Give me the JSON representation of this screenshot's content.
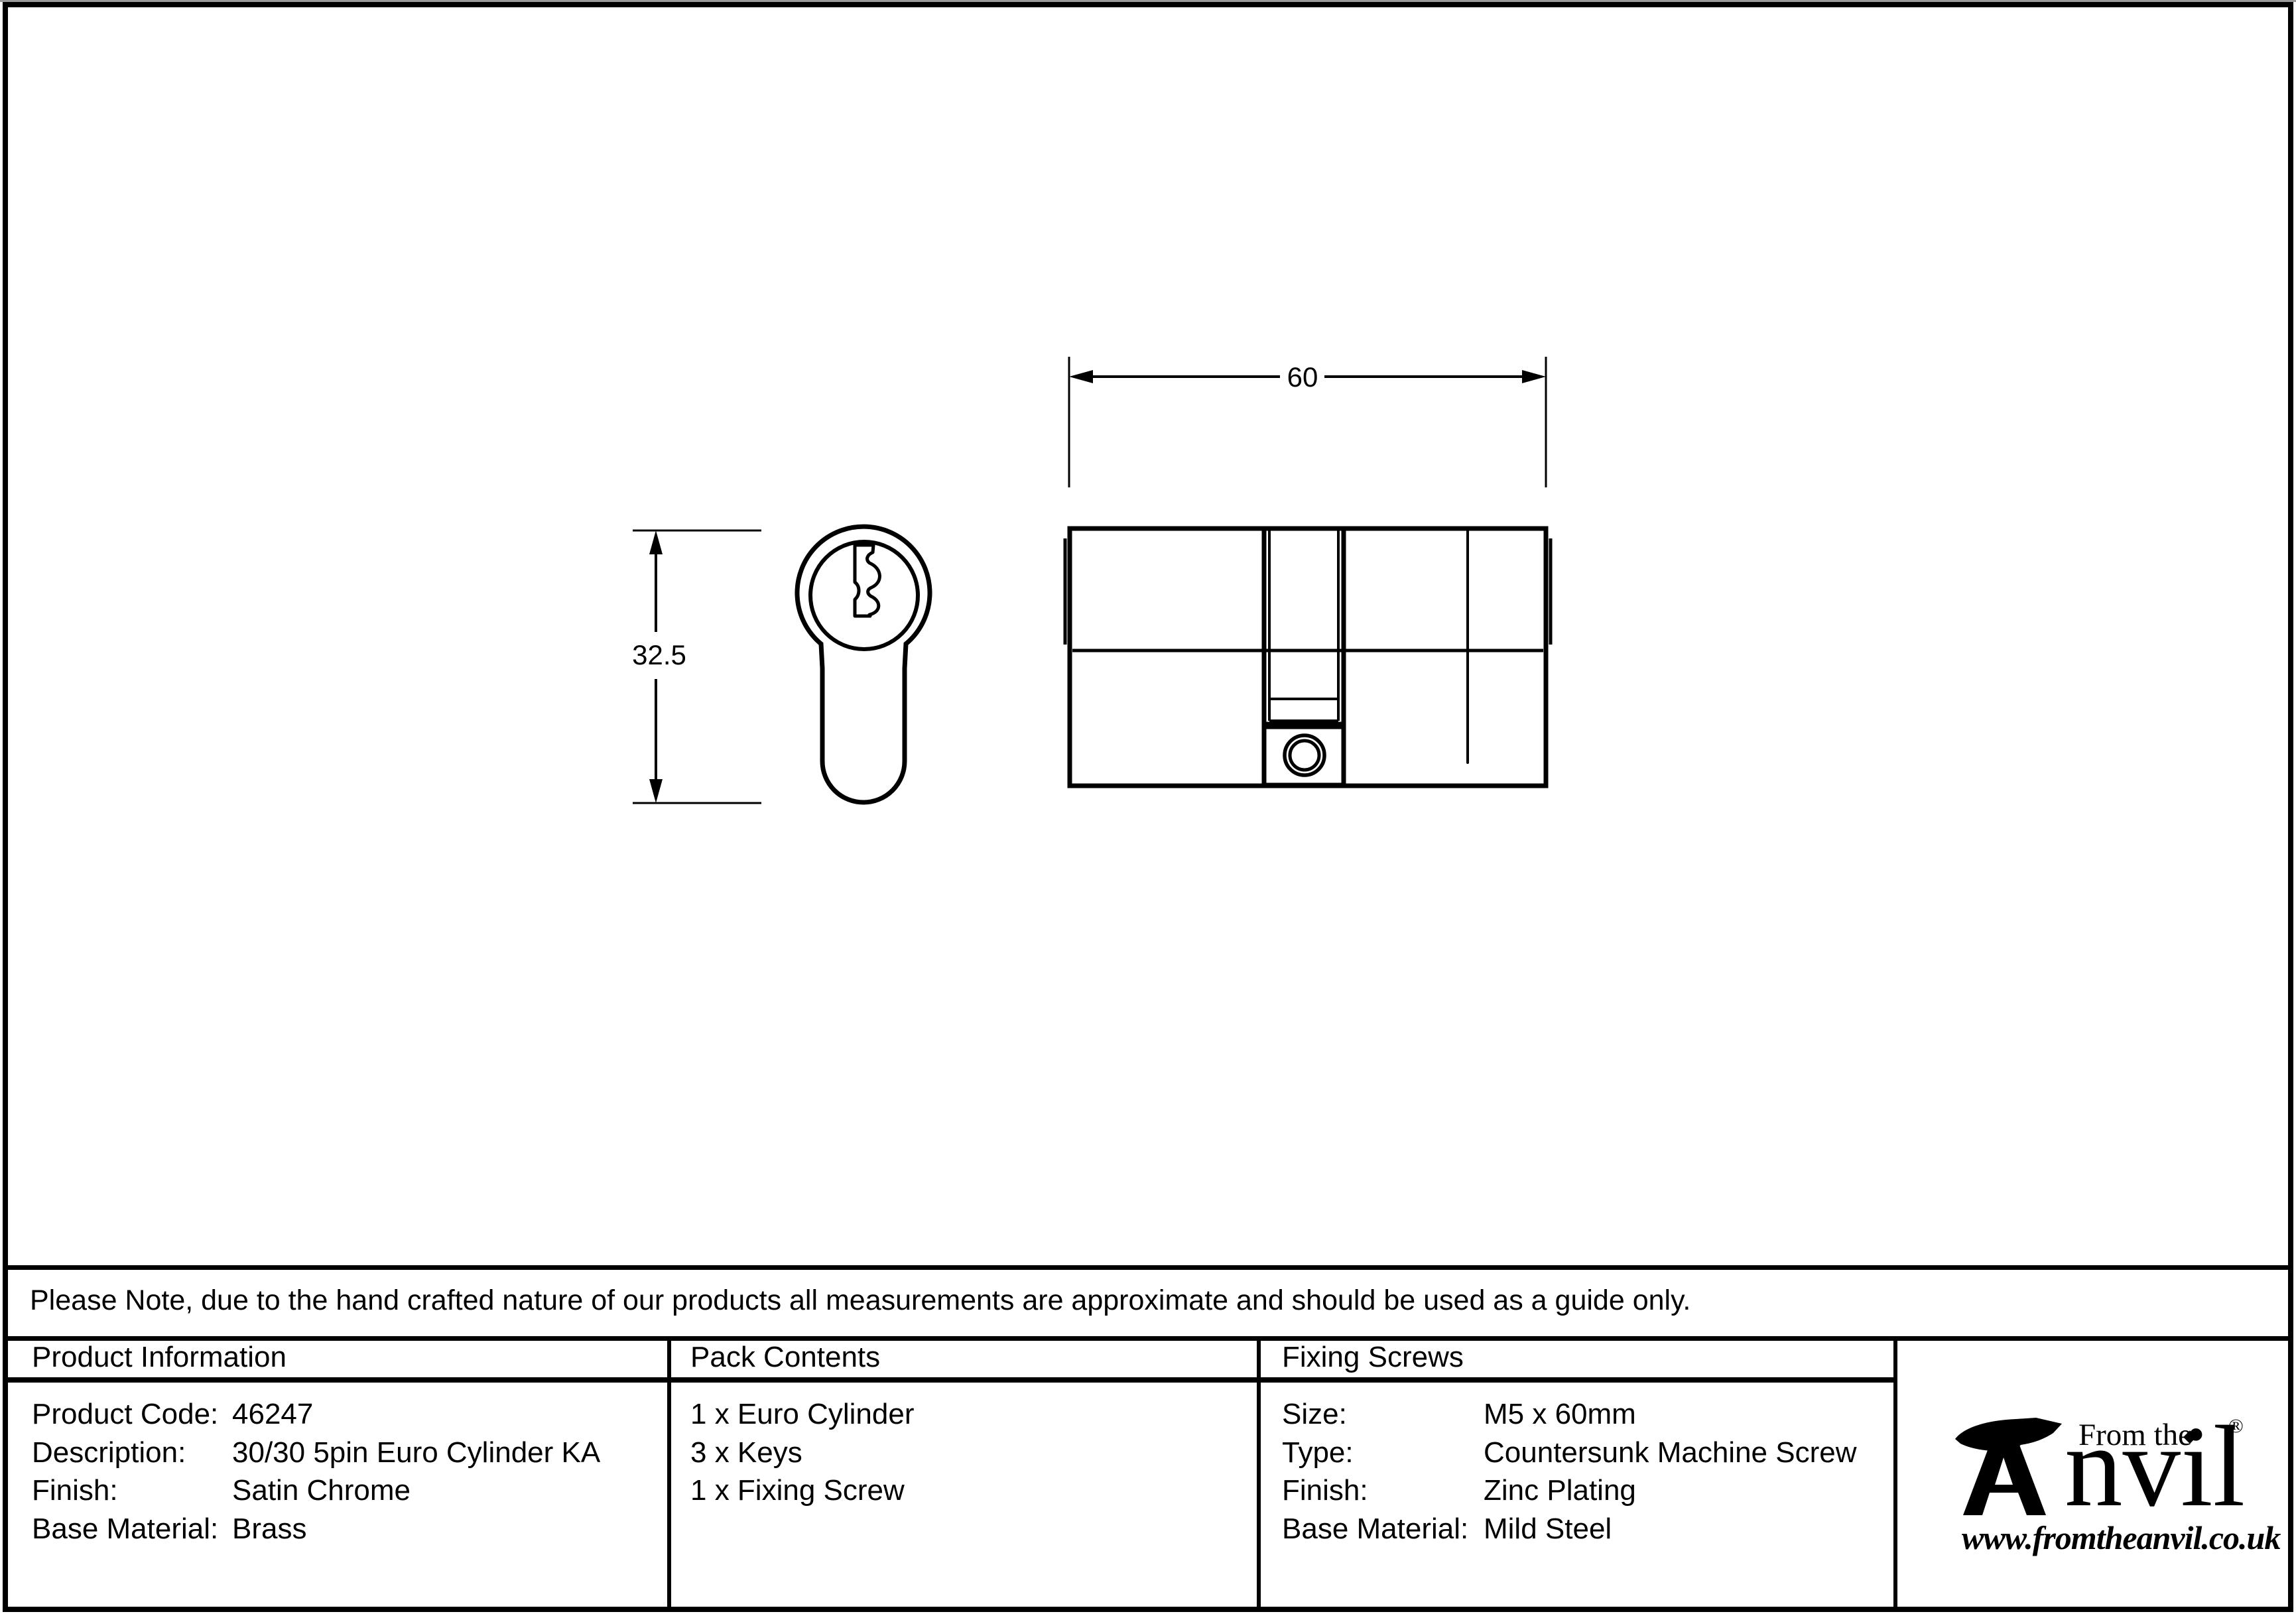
{
  "drawing": {
    "width_dim": "60",
    "height_dim": "32.5"
  },
  "note": "Please Note, due to the hand crafted nature of our products all measurements are approximate and should be used as a guide only.",
  "table": {
    "product_information": {
      "header": "Product Information",
      "rows": [
        {
          "label": "Product Code:",
          "value": "46247"
        },
        {
          "label": "Description:",
          "value": "30/30 5pin Euro Cylinder KA"
        },
        {
          "label": "Finish:",
          "value": "Satin Chrome"
        },
        {
          "label": "Base Material:",
          "value": "Brass"
        }
      ]
    },
    "pack_contents": {
      "header": "Pack Contents",
      "items": [
        "1 x Euro Cylinder",
        "3 x Keys",
        "1 x Fixing Screw"
      ]
    },
    "fixing_screws": {
      "header": "Fixing Screws",
      "rows": [
        {
          "label": "Size:",
          "value": "M5 x 60mm"
        },
        {
          "label": "Type:",
          "value": "Countersunk Machine Screw"
        },
        {
          "label": "Finish:",
          "value": "Zinc Plating"
        },
        {
          "label": "Base Material:",
          "value": "Mild Steel"
        }
      ]
    }
  },
  "logo": {
    "tagline": "From the",
    "brand_rest": "nvil",
    "diamond": "◆",
    "registered": "®",
    "url": "www.fromtheanvil.co.uk"
  },
  "colors": {
    "ink": "#000000",
    "background": "#ffffff"
  }
}
